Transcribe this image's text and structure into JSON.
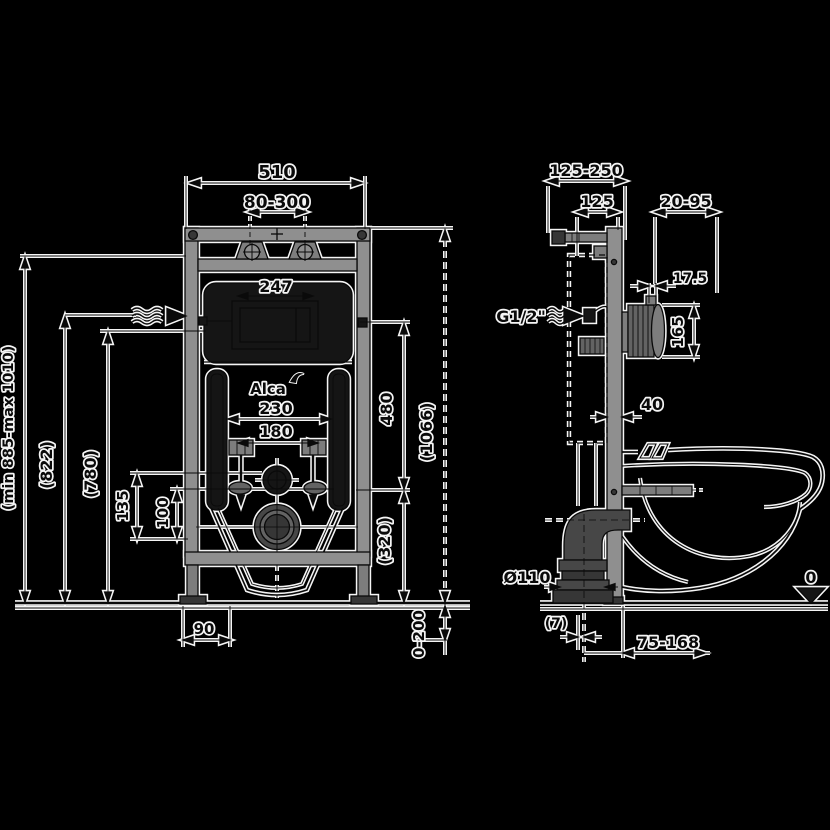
{
  "drawing": {
    "brand": "Alca",
    "front_view": {
      "total_width": "510",
      "hanger_spacing": "80-300",
      "flush_window_width": "247",
      "bolt_spacing_outer": "230",
      "bolt_spacing_inner": "180",
      "height_adjust_range": "(min 885-max 1010)",
      "inlet_height": "(822)",
      "window_height": "(780)",
      "slot_offset_a": "135",
      "slot_offset_b": "100",
      "upper_span": "480",
      "frame_height": "(1066)",
      "lower_span": "(320)",
      "foot_width": "90",
      "foot_extension": "0-200"
    },
    "side_view": {
      "wall_distance": "125-250",
      "cistern_depth": "125",
      "front_clearance": "20-95",
      "plate_offset": "17.5",
      "box_height": "165",
      "profile_depth": "40",
      "water_supply_thread": "G1/2\"",
      "drain_diameter": "Ø110",
      "floor_offset": "(7)",
      "drain_distance": "75-168",
      "datum_level": "0"
    }
  }
}
